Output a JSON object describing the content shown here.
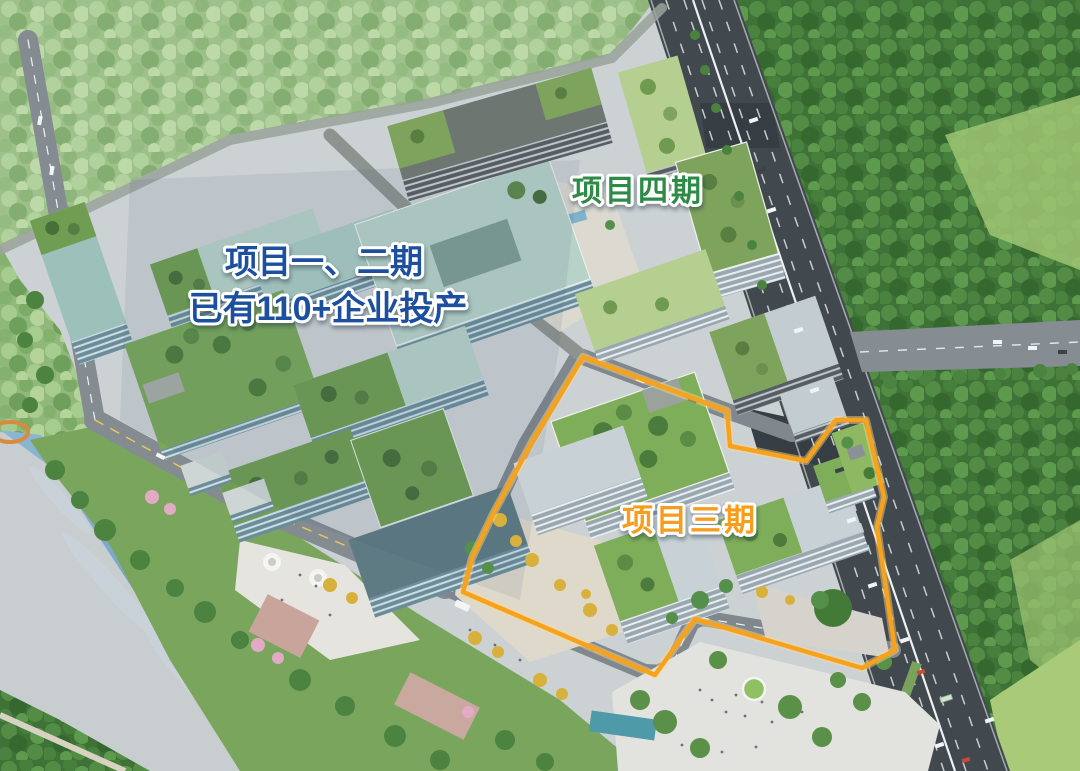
{
  "scene": {
    "labels": {
      "phase12_line1": "项目一、二期",
      "phase12_line2": "已有110+企业投产",
      "phase4": "项目四期",
      "phase3": "项目三期"
    },
    "label_colors": {
      "phase12": "#1d4f9e",
      "phase4": "#2e8b47",
      "phase3": "#f69d1e"
    },
    "boundary": {
      "area_label": "项目三期",
      "color": "#f6a21c"
    },
    "palette": {
      "water": "#6f9fc4",
      "forest": "#3f7237",
      "forest_light": "#9cc084",
      "main_road": "#42494e",
      "campus_road": "#80878d",
      "green_roof": "#7fae5a",
      "glass_roof": "#b7d2c8",
      "plaza": "#dfdcd2"
    }
  }
}
